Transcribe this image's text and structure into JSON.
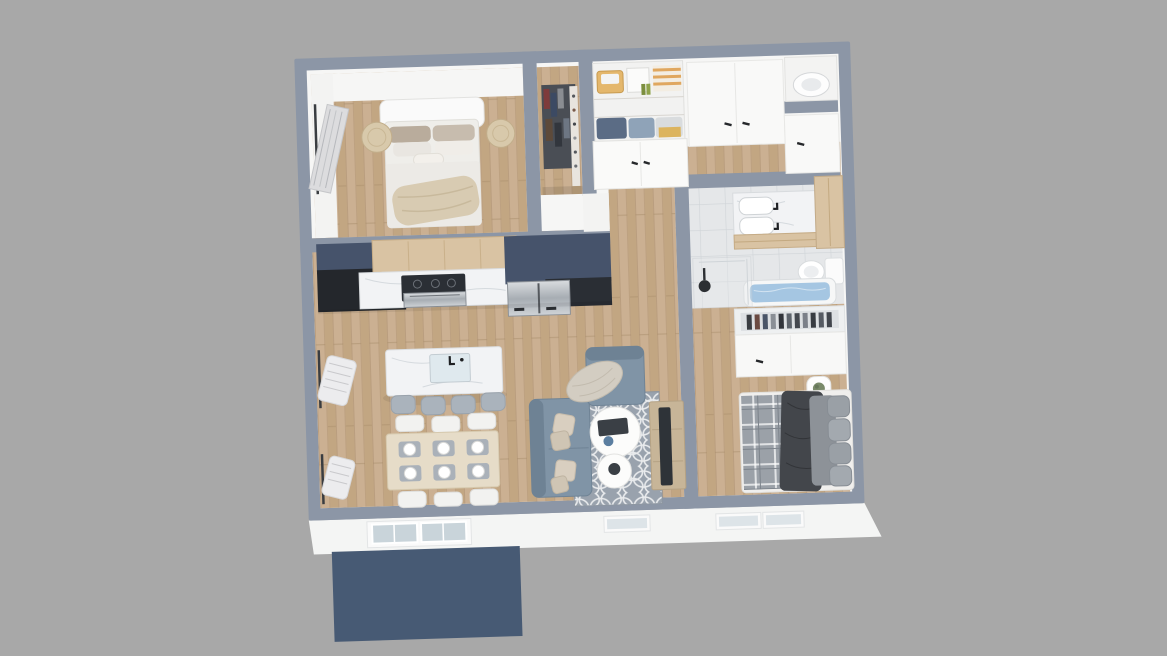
{
  "meta": {
    "description": "3D rendered top-down (dollhouse) floor plan of a two-bedroom apartment, viewed from above on a plain gray background",
    "style": "axonometric architectural render, slightly rotated",
    "visible_text": "none"
  },
  "palette": {
    "background": "#a8a8a8",
    "wall_band": "#8c96a6",
    "interior_white": "#f6f6f5",
    "facade_white": "#f4f5f4",
    "floor_wood": "#cbb092",
    "floor_tile": "#e5e7e9",
    "porch_navy": "#475a74",
    "cabinet_navy": "#46536b",
    "cabinet_black": "#24272c",
    "counter_marble": "#f2f3f5",
    "wood_light": "#d9c3a3",
    "stainless": "#b9bec4",
    "sofa_gray": "#8094a6",
    "cushion_beige": "#d9cfc0",
    "rug_gray": "#99a2ad",
    "rug_pattern_white": "#e9ebed",
    "tub_water_blue": "#a5c6e2",
    "bedding_white": "#efeeea",
    "throw_beige": "#d8cbb2",
    "bed2_plaid_gray": "#9ba1a8",
    "bed2_charcoal": "#43464b",
    "tv_dark": "#2e3338",
    "tv_console_wood": "#c7b598",
    "plant_green": "#7a8a6a",
    "glass_blue": "#c9d4da",
    "rattan": "#d8c9ab"
  },
  "rooms": [
    {
      "id": "bedroom-1",
      "label": "Bedroom 1",
      "position": "top-left",
      "floor": "wood planks",
      "furniture": [
        "double bed with white duvet and beige throw",
        "white headboard",
        "gray and taupe pillows",
        "two rattan poufs at bed sides",
        "wall-mounted clothes rack on left wall"
      ]
    },
    {
      "id": "walk-in-closet",
      "label": "Walk-in Closet",
      "position": "top-center",
      "floor": "wood planks",
      "furniture": [
        "hanging clothes rail",
        "shoe shelf along right side"
      ]
    },
    {
      "id": "storage-closet",
      "label": "Storage Closet",
      "position": "top-center-right",
      "floor": "hidden",
      "furniture": [
        "open shelves with basket, white box, striped towels, bottles and folded linens",
        "white double doors with black handles"
      ]
    },
    {
      "id": "hallway",
      "label": "Hallway",
      "position": "top-right",
      "floor": "wood planks",
      "furniture": [
        "built-in white closets with black handles",
        "appliance niche with washing machine in top-right corner"
      ]
    },
    {
      "id": "bathroom",
      "label": "Bathroom",
      "position": "right-middle",
      "floor": "white tile",
      "furniture": [
        "marble vanity with white basins and black faucets",
        "light-wood vanity base",
        "tall light-wood cabinet",
        "toilet",
        "bathtub filled with water",
        "glass shower with black fixture"
      ]
    },
    {
      "id": "bedroom-2",
      "label": "Bedroom 2",
      "position": "bottom-right",
      "floor": "wood planks",
      "furniture": [
        "open closet with row of hanging clothes",
        "white closet doors with black handle",
        "double bed with gray plaid, charcoal throw and gray duvet",
        "stacked gray pillows",
        "round white nightstand with plant"
      ]
    },
    {
      "id": "kitchen",
      "label": "Kitchen",
      "position": "center-left against bedroom wall",
      "floor": "wood planks",
      "furniture": [
        "navy upper cabinet blocks",
        "light-wood hood panel",
        "black corner base cabinets",
        "marble counter with black range and steel oven",
        "stainless french-door refrigerator"
      ]
    },
    {
      "id": "living-dining",
      "label": "Living / Dining",
      "position": "center-bottom",
      "floor": "wood planks",
      "furniture": [
        "marble kitchen island with inset sink and 4 gray stools",
        "light-wood dining table with 6 white chairs and 6 place settings",
        "gray fabric sofa with beige cushions",
        "gray armchair with beige throw blanket",
        "gray trellis-pattern rug",
        "two round white coffee tables with dark trays",
        "wood TV console with flat TV",
        "two wall radiators below black-framed windows"
      ]
    }
  ],
  "exterior": {
    "facade": "white south facade with gray-blue wall caps",
    "openings": [
      "glazed entry door (two panes)",
      "three small windows along south facade"
    ],
    "porch": "navy-blue rectangular entry slab extending from the facade"
  }
}
